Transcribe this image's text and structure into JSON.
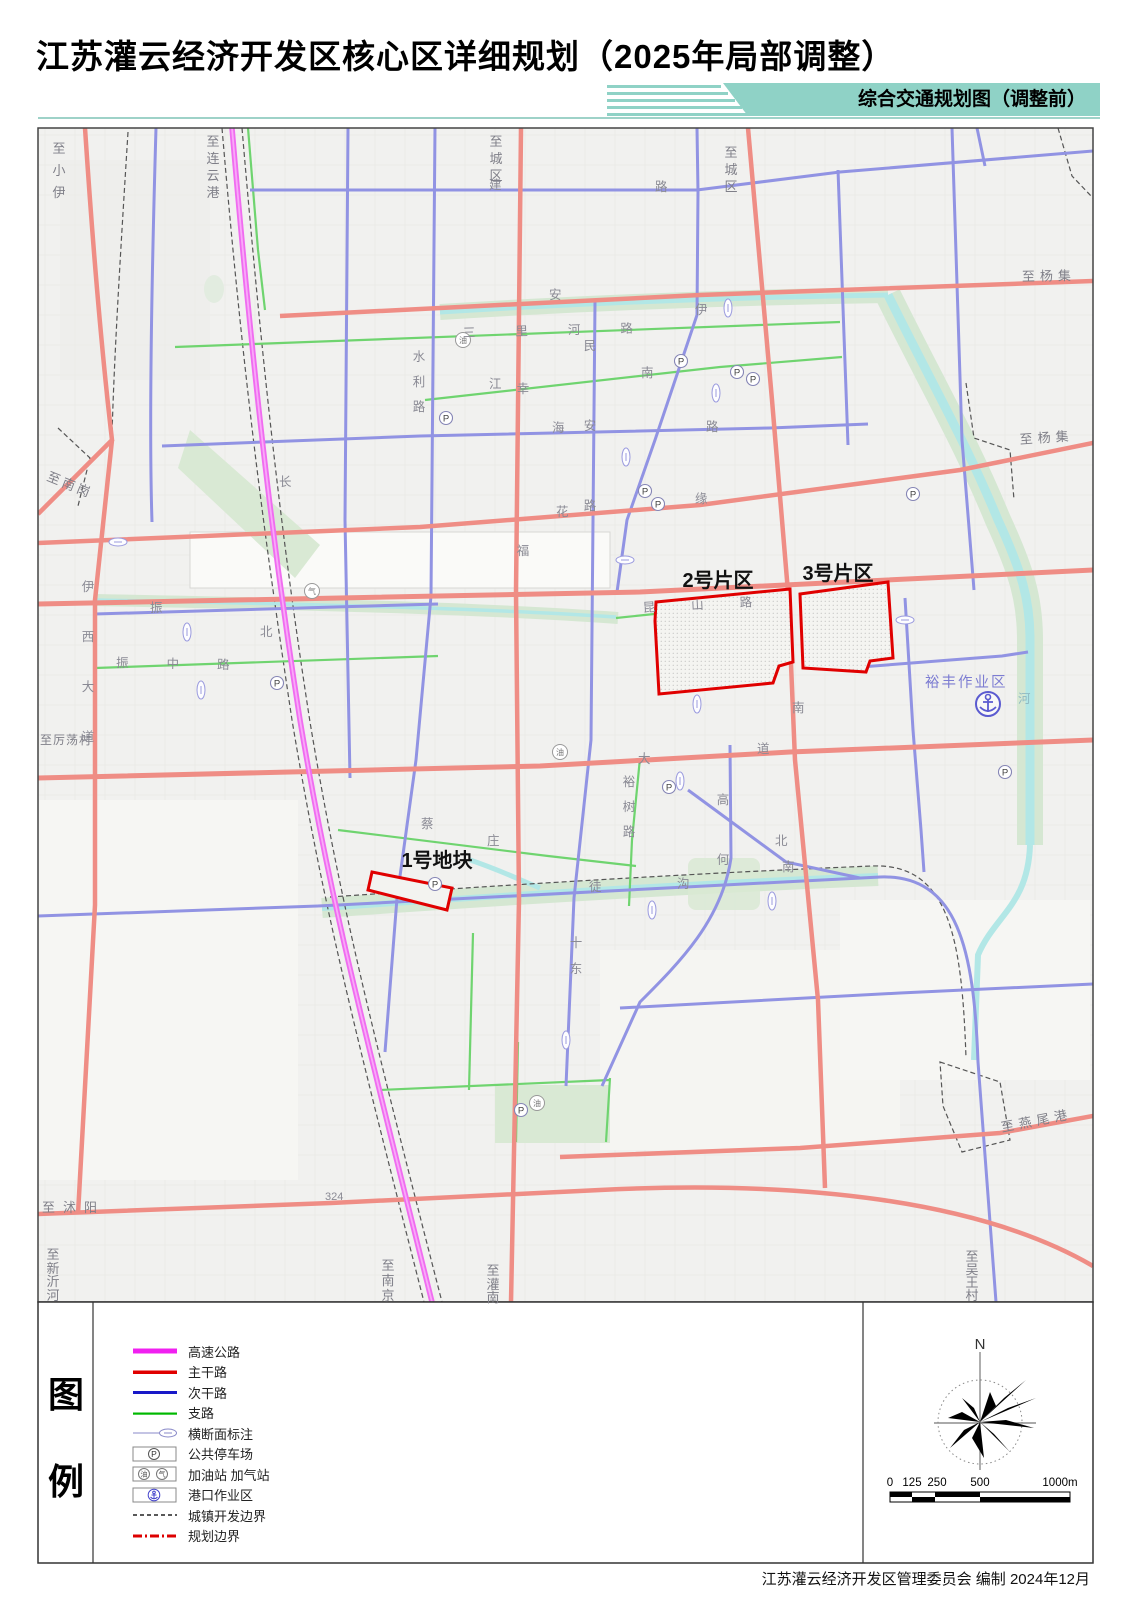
{
  "header": {
    "title": "江苏灌云经济开发区核心区详细规划（2025年局部调整）",
    "ribbon": "综合交通规划图（调整前）"
  },
  "colors": {
    "ribbon_teal": "#8fd2c6",
    "highway": "#f06cf0",
    "arterial": "#ef8d85",
    "secondary": "#9193e3",
    "branch": "#6fd46f",
    "river": "#b2e7e6",
    "legend_highway": "#f020f0",
    "legend_arterial": "#e00000",
    "legend_secondary": "#1818c8",
    "legend_branch": "#00b800",
    "boundary_red": "#dd0000"
  },
  "map": {
    "area_labels": {
      "zone2": "2号片区",
      "zone3": "3号片区",
      "plot1": "1号地块",
      "port_area": "裕丰作业区"
    },
    "edge_labels": {
      "xiaoyi": "至小伊",
      "lianyungang": "至连云港",
      "chengqu_a": "至城区",
      "chengqu_b": "至城区",
      "yangji_a": "至杨集",
      "yangji_b": "至杨集",
      "nangang": "至南岗",
      "lidangcun": "至厉荡村",
      "shuyang": "至沭阳",
      "xinyihe": "至新沂河",
      "nanjing": "至南京",
      "guannan": "至灌南",
      "wuwangcun": "至吴王村",
      "yanweigang": "至燕尾港"
    },
    "road_labels": {
      "jian": "建",
      "lu_a": "路",
      "shuili_lu": "水利路",
      "minan_lu": "民安路",
      "xingfu": "幸福",
      "hai": "海",
      "lu_b": "路",
      "sanlihe_lu": "三里河路",
      "jiang": "江",
      "nan_a": "南",
      "an": "安",
      "yi": "伊",
      "kunshan_lu": "昆山路",
      "yixi_dadao": "伊西大道",
      "zhenzhong_lu": "振中路",
      "zhen": "振",
      "da": "大",
      "dao": "道",
      "nan_b": "南",
      "yushu_lu": "裕树路",
      "gaohe": "高何",
      "cai": "蔡",
      "zhuang": "庄",
      "tu": "徒",
      "gou": "沟",
      "bei_a": "北",
      "nan_c": "南",
      "bei_b": "北",
      "shidong": "十东",
      "hua": "花",
      "yuan": "缘",
      "chang": "长",
      "he_river": "河",
      "route_324": "324"
    },
    "symbols": {
      "parking": "P",
      "oil": "油",
      "gas": "气"
    }
  },
  "legend": {
    "title_chars": [
      "图",
      "例"
    ],
    "items": [
      "高速公路",
      "主干路",
      "次干路",
      "支路",
      "横断面标注",
      "公共停车场",
      "加油站 加气站",
      "港口作业区",
      "城镇开发边界",
      "规划边界"
    ]
  },
  "compass": {
    "north": "N"
  },
  "scalebar": {
    "ticks": [
      "0",
      "125",
      "250",
      "500",
      "1000m"
    ]
  },
  "footer": {
    "credit": "江苏灌云经济开发区管理委员会 编制 2024年12月"
  }
}
